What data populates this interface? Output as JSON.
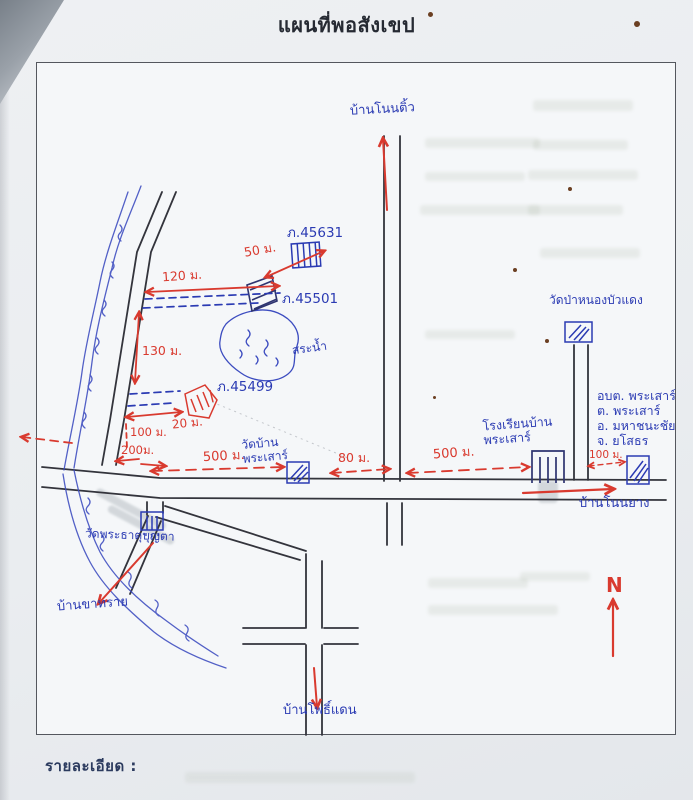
{
  "title": "แผนที่พอสังเขป",
  "details_label": "รายละเอียด :",
  "compass": {
    "north_label": "N"
  },
  "villages": {
    "non_tio": "บ้านโนนติ้ว",
    "non_yang": "บ้านโนนยาง",
    "pho_daen": "บ้านโพธิ์แดน",
    "kha_sai": "บ้านขาทราย"
  },
  "temples": {
    "wat_ban_line1": "วัดบ้าน",
    "wat_ban_line2": "พระเสาร์",
    "wat_pa_nong_bua_daeng": "วัดป่าหนองบัวแดง",
    "wat_phra_that_bun_ta": "วัดพระธาตุบุญตา"
  },
  "school": {
    "line1": "โรงเรียนบ้าน",
    "line2": "พระเสาร์"
  },
  "sao_office": {
    "line1": "อบต. พระเสาร์",
    "line2": "ต. พระเสาร์",
    "line3": "อ. มหาชนะชัย",
    "line4": "จ. ยโสธร"
  },
  "parcels": {
    "p45631": "ภ.45631",
    "p45501": "ภ.45501",
    "p45499": "ภ.45499"
  },
  "water": {
    "pond_label": "สระน้ำ"
  },
  "distances": {
    "d50": "50 ม.",
    "d120": "120 ม.",
    "d130": "130 ม.",
    "d20": "20 ม.",
    "d100_left": "100 ม.",
    "d200": "200ม.",
    "d500_left": "500 ม.",
    "d80": "80 ม.",
    "d500_right": "500 ม.",
    "d100_right": "100 ม."
  },
  "colors": {
    "red_pen": "#d93a2f",
    "blue_pen": "#2b3bb3",
    "black_pen": "#33343c",
    "paper": "#f5f7f9"
  }
}
